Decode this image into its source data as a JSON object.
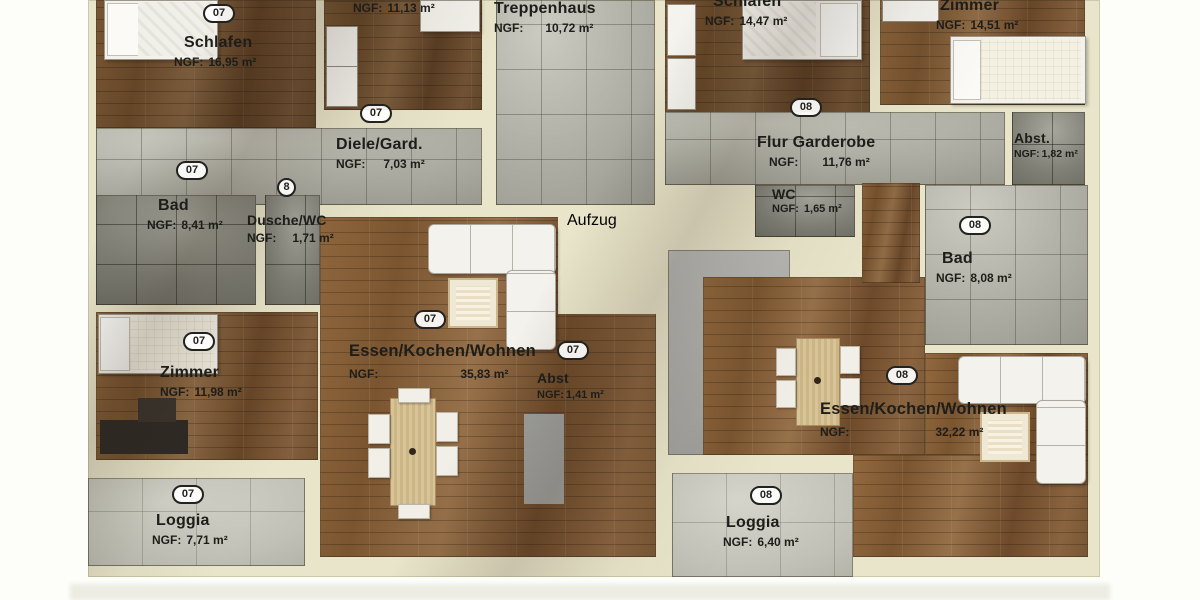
{
  "plan": {
    "badges": {
      "unit07": "07",
      "unit08": "08",
      "small8": "8"
    },
    "rooms": {
      "schlafen_07": {
        "name": "Schlafen",
        "ngf_label": "NGF:",
        "area": "16,95 m²"
      },
      "zimmer_klein_07": {
        "ngf_label": "NGF:",
        "area": "11,13 m²"
      },
      "treppenhaus": {
        "name": "Treppenhaus",
        "ngf_label": "NGF:",
        "area": "10,72 m²"
      },
      "schlafen_08": {
        "name": "Schlafen",
        "ngf_label": "NGF:",
        "area": "14,47 m²"
      },
      "zimmer_08": {
        "name": "Zimmer",
        "ngf_label": "NGF:",
        "area": "14,51 m²"
      },
      "abst_08": {
        "name": "Abst.",
        "ngf_label": "NGF:",
        "area": "1,82 m²"
      },
      "diele_07": {
        "name": "Diele/Gard.",
        "ngf_label": "NGF:",
        "area": "7,03 m²"
      },
      "flur_08": {
        "name": "Flur Garderobe",
        "ngf_label": "NGF:",
        "area": "11,76 m²"
      },
      "bad_07": {
        "name": "Bad",
        "ngf_label": "NGF:",
        "area": "8,41 m²"
      },
      "dusche_wc_07": {
        "name": "Dusche/WC",
        "ngf_label": "NGF:",
        "area": "1,71 m²"
      },
      "wc_08": {
        "name": "WC",
        "ngf_label": "NGF:",
        "area": "1,65 m²"
      },
      "bad_08": {
        "name": "Bad",
        "ngf_label": "NGF:",
        "area": "8,08 m²"
      },
      "zimmer_07": {
        "name": "Zimmer",
        "ngf_label": "NGF:",
        "area": "11,98 m²"
      },
      "wohnen_07": {
        "name": "Essen/Kochen/Wohnen",
        "ngf_label": "NGF:",
        "area": "35,83 m²"
      },
      "abst_07": {
        "name": "Abst",
        "ngf_label": "NGF:",
        "area": "1,41 m²"
      },
      "wohnen_08": {
        "name": "Essen/Kochen/Wohnen",
        "ngf_label": "NGF:",
        "area": "32,22 m²"
      },
      "loggia_07": {
        "name": "Loggia",
        "ngf_label": "NGF:",
        "area": "7,71 m²"
      },
      "loggia_08": {
        "name": "Loggia",
        "ngf_label": "NGF:",
        "area": "6,40 m²"
      },
      "aufzug": {
        "name": "Aufzug"
      }
    },
    "colors": {
      "wall": "#e9e5ca",
      "wood_floor": "#8a6440",
      "stone_tile": "#b0b0a6",
      "door": "#a85f49",
      "kitchen_counter": "#d79b52",
      "elevator": "#0c0c0f"
    }
  }
}
